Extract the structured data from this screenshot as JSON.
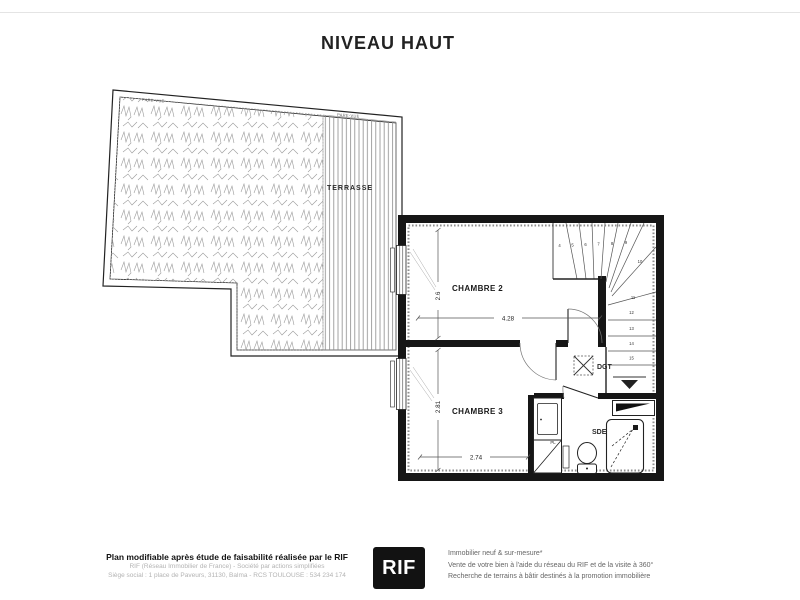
{
  "title": "NIVEAU HAUT",
  "plan": {
    "terrace": {
      "label": "TERRASSE",
      "screen_left": "PARE-VUE",
      "screen_right": "PARE-VUE"
    },
    "rooms": {
      "chambre2": {
        "name": "CHAMBRE 2",
        "width_m": "4.28",
        "depth_m": "2.6"
      },
      "chambre3": {
        "name": "CHAMBRE 3",
        "width_m": "2.74",
        "depth_m": "2.81"
      },
      "dgt": {
        "name": "DGT"
      },
      "sde": {
        "name": "SDE"
      },
      "placard": {
        "name": "PL"
      }
    },
    "stairs": {
      "steps": [
        "4",
        "5",
        "6",
        "7",
        "8",
        "9",
        "10",
        "11",
        "12",
        "13",
        "14",
        "15"
      ],
      "direction": "down"
    }
  },
  "footer": {
    "disclaimer": "Plan modifiable après étude de faisabilité réalisée par le RIF",
    "company": "RIF (Réseau Immobilier de France) - Société par actions simplifiées",
    "address": "Siège social : 1 place de Paveurs, 31130, Balma - RCS TOULOUSE : 534 234 174",
    "logo": "RIF",
    "services": [
      "Immobilier neuf & sur-mesure*",
      "Vente de votre bien à l'aide du réseau du RIF et de la visite à 360°",
      "Recherche de terrains à bâtir destinés à la promotion immobilière"
    ]
  },
  "colors": {
    "wall": "#161616",
    "line": "#3a3a3a",
    "hatch": "#9a9a9a",
    "logo_bg": "#121212",
    "logo_text": "#ffffff"
  }
}
